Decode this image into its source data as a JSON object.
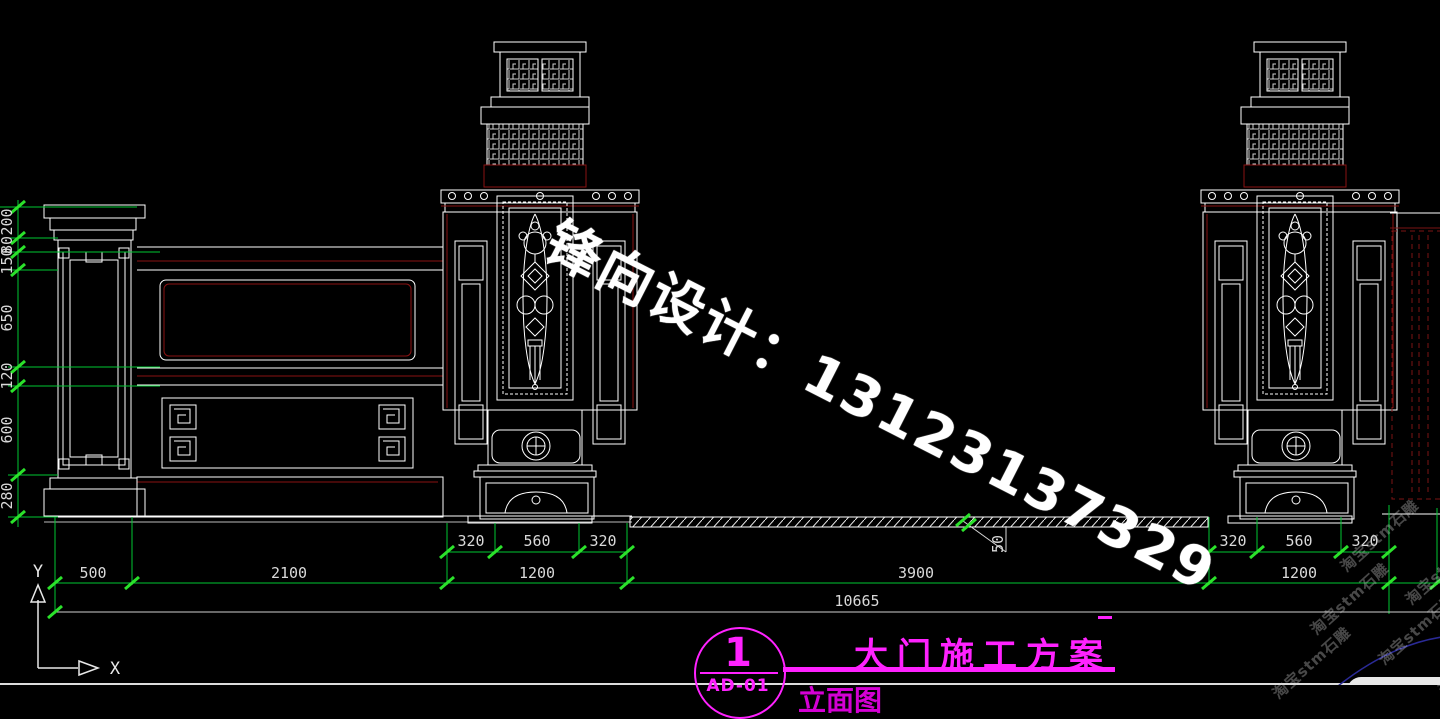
{
  "meta": {
    "type": "cad-elevation-drawing",
    "background": "#000000"
  },
  "colors": {
    "line_white": "#ffffff",
    "dim_green": "#00c832",
    "tick_green": "#2be22b",
    "accent_red": "#8a1212",
    "gate_dashed_red": "#7d1414",
    "title_magenta": "#ff22ff",
    "arc_blue": "#2a2a96"
  },
  "axis": {
    "x": "X",
    "y": "Y"
  },
  "dims": {
    "left_chain": [
      "200",
      "80",
      "150",
      "650",
      "120",
      "600",
      "280"
    ],
    "bottom": {
      "seg1": "500",
      "seg2": "2100",
      "gate": "3900",
      "overall": "10665"
    },
    "pillar_center": {
      "left": "320",
      "mid": "560",
      "right": "320",
      "total": "1200"
    },
    "pillar_right": {
      "left": "320",
      "mid": "560",
      "right": "320",
      "total": "1200"
    },
    "ground_leader": "50"
  },
  "title_block": {
    "number": "1",
    "title": "大门施工方案",
    "code": "AD-01",
    "subtitle": "立面图"
  },
  "watermarks": {
    "designer": "锋向设计：13123137329",
    "shop": "淘宝stm石雕"
  }
}
